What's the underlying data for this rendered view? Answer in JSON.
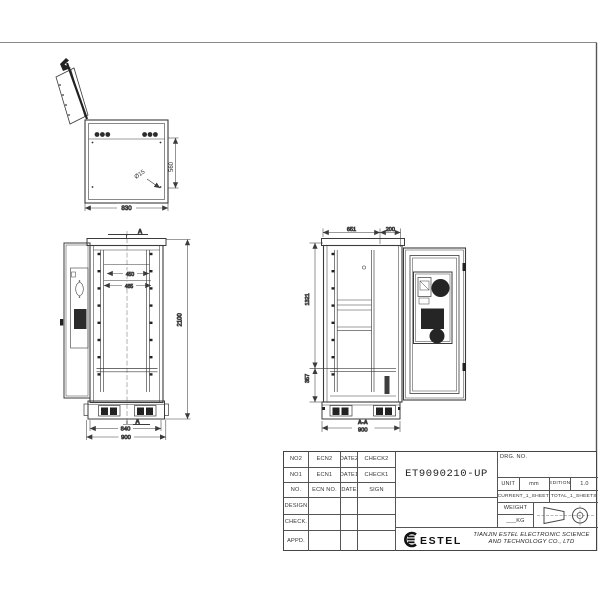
{
  "title_block": {
    "drg_no_label": "DRG. NO.",
    "drawing_number": "ET9090210-UP",
    "unit_label": "UNIT",
    "unit_value": "mm",
    "edition_label": "EDITION",
    "edition_value": "1.0",
    "current_sheet": "CURRENT_1_SHEET",
    "total_sheets": "TOTAL_1_SHEETS",
    "weight_label": "WEIGHT",
    "weight_value": "___KG",
    "logo_text": "ESTEL",
    "company_name_line1": "TIANJIN ESTEL ELECTRONIC SCIENCE",
    "company_name_line2": "AND TECHNOLOGY CO., LTD",
    "rev_rows": [
      {
        "no": "NO2",
        "ecn": "ECN2",
        "date": "DATE2",
        "check": "CHECK2"
      },
      {
        "no": "NO1",
        "ecn": "ECN1",
        "date": "DATE1",
        "check": "CHECK1"
      },
      {
        "no": "NO.",
        "ecn": "ECN NO.",
        "date": "DATE",
        "check": "SIGN"
      }
    ],
    "approval_rows": [
      {
        "label": "DESIGN"
      },
      {
        "label": "CHECK."
      },
      {
        "label": "APPD."
      }
    ]
  },
  "views": {
    "top_view": {
      "width_dim": "830",
      "depth_dim": "560",
      "hole_dim": "Ø15"
    },
    "front_view": {
      "height_dim": "2100",
      "rail_dim_1": "450",
      "rail_dim_2": "485",
      "base_width_dim": "840",
      "overall_width_dim": "900",
      "section_letter": "A"
    },
    "side_view": {
      "top_dim_1": "651",
      "top_dim_2": "200",
      "upper_dim": "1321",
      "lower_dim": "357",
      "width_dim": "900",
      "section_title": "A-A"
    }
  }
}
